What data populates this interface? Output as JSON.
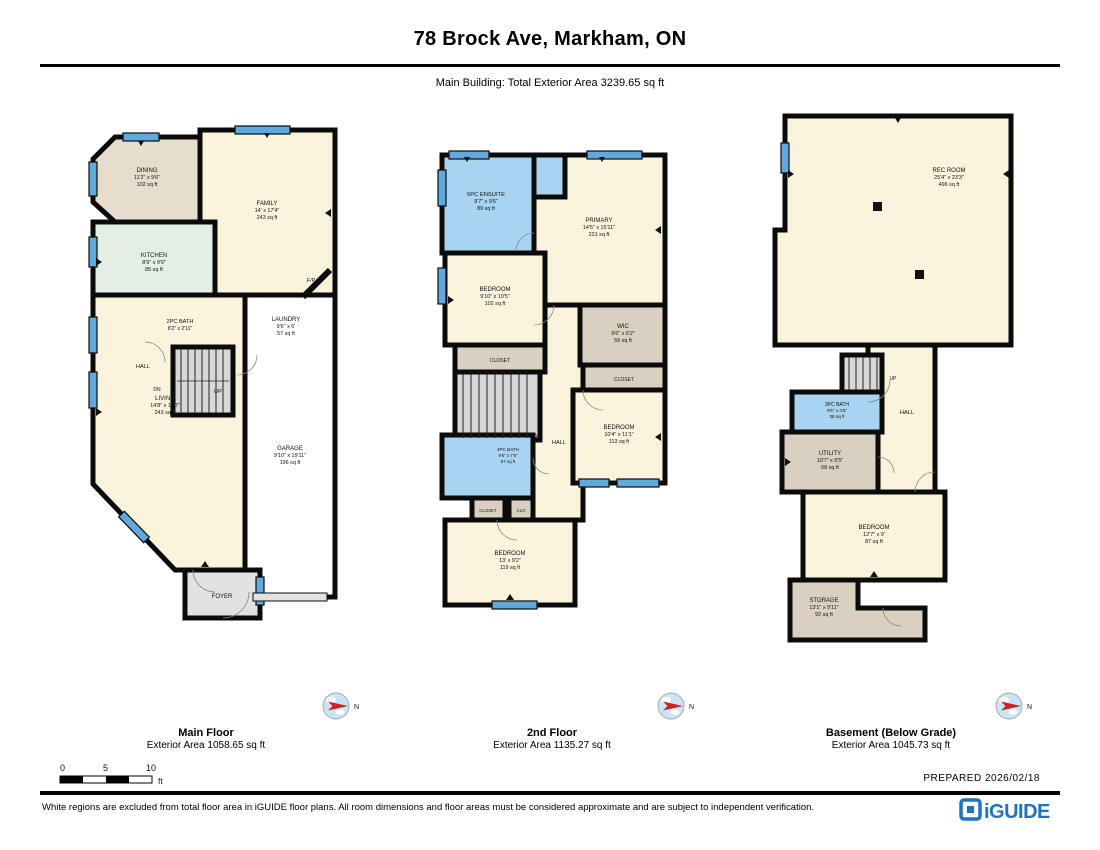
{
  "header": {
    "title": "78 Brock Ave, Markham, ON",
    "subtitle": "Main Building: Total Exterior Area 3239.65 sq ft"
  },
  "palette": {
    "wall": "#0b0b0b",
    "cream": "#FBF4DD",
    "tan": "#E7DDCC",
    "closet_tan": "#D9D0C1",
    "mint": "#E3EFE5",
    "bath_blue": "#A9D4F1",
    "window_blue": "#5FA9DC",
    "stairs_gray": "#D8D8D8",
    "foyer_gray": "#E2E2E2",
    "garage_white": "#FFFFFF",
    "compass_red": "#D02020",
    "compass_blue": "#C8E4F5",
    "brand_blue": "#1C75BC"
  },
  "floors": [
    {
      "label": "Main Floor",
      "area_label": "Exterior Area 1058.65 sq ft",
      "rooms": {
        "dining": {
          "name": "DINING",
          "dims": "11'2\" x 9'6\"",
          "area": "102 sq ft"
        },
        "family": {
          "name": "FAMILY",
          "dims": "14' x 17'4\"",
          "area": "243 sq ft"
        },
        "kitchen": {
          "name": "KITCHEN",
          "dims": "8'9\" x 9'9\"",
          "area": "85 sq ft"
        },
        "bath": {
          "name": "2PC BATH",
          "dims": "8'2\" x 2'11\"",
          "area": ""
        },
        "laundry": {
          "name": "LAUNDRY",
          "dims": "9'6\" x 6'",
          "area": "57 sq ft"
        },
        "living": {
          "name": "LIVING",
          "dims": "14'8\" x 17'7\"",
          "area": "243 sq ft"
        },
        "garage": {
          "name": "GARAGE",
          "dims": "9'10\" x 19'11\"",
          "area": "196 sq ft"
        },
        "foyer": {
          "name": "FOYER"
        }
      },
      "annotations": {
        "hall": "HALL",
        "dn": "DN",
        "up": "UP",
        "fp": "F/P"
      }
    },
    {
      "label": "2nd Floor",
      "area_label": "Exterior Area 1135.27 sq ft",
      "rooms": {
        "ensuite": {
          "name": "5PC ENSUITE",
          "dims": "9'7\" x 9'6\"",
          "area": "89 sq ft"
        },
        "primary": {
          "name": "PRIMARY",
          "dims": "14'5\" x 15'11\"",
          "area": "221 sq ft"
        },
        "bedroom_l": {
          "name": "BEDROOM",
          "dims": "9'10\" x 10'5\"",
          "area": "102 sq ft"
        },
        "wic": {
          "name": "WIC",
          "dims": "9'6\" x 6'2\"",
          "area": "59 sq ft"
        },
        "closet_l": {
          "name": "CLOSET"
        },
        "closet_r": {
          "name": "CLOSET"
        },
        "bedroom_r": {
          "name": "BEDROOM",
          "dims": "10'4\" x 11'1\"",
          "area": "113 sq ft"
        },
        "bath": {
          "name": "4PC BATH",
          "dims": "9'6\" x 7'6\"",
          "area": "57 sq ft"
        },
        "closet_s": {
          "name": "CLOSET"
        },
        "clo": {
          "name": "CLO"
        },
        "bedroom_b": {
          "name": "BEDROOM",
          "dims": "13' x 9'2\"",
          "area": "119 sq ft"
        }
      },
      "annotations": {
        "dn": "DN",
        "hall": "HALL"
      }
    },
    {
      "label": "Basement (Below Grade)",
      "area_label": "Exterior Area 1045.73 sq ft",
      "rooms": {
        "rec": {
          "name": "REC ROOM",
          "dims": "25'4\" x 23'3\"",
          "area": "496 sq ft"
        },
        "bath": {
          "name": "3PC BATH",
          "dims": "9'5\" x 4'5\"",
          "area": "38 sq ft"
        },
        "utility": {
          "name": "UTILITY",
          "dims": "10'7\" x 6'5\"",
          "area": "68 sq ft"
        },
        "bedroom": {
          "name": "BEDROOM",
          "dims": "12'7\" x 9'",
          "area": "87 sq ft"
        },
        "storage": {
          "name": "STORAGE",
          "dims": "13'1\" x 9'11\"",
          "area": "92 sq ft"
        }
      },
      "annotations": {
        "up": "UP",
        "hall": "HALL"
      }
    }
  ],
  "compass_label": "N",
  "scale_bar": {
    "ticks": [
      "0",
      "5",
      "10"
    ],
    "unit": "ft"
  },
  "prepared": "PREPARED  2026/02/18",
  "disclaimer": "White regions are excluded from total floor area in iGUIDE floor plans. All room dimensions and floor areas must be considered approximate and are subject to independent verification.",
  "brand": "iGUIDE"
}
